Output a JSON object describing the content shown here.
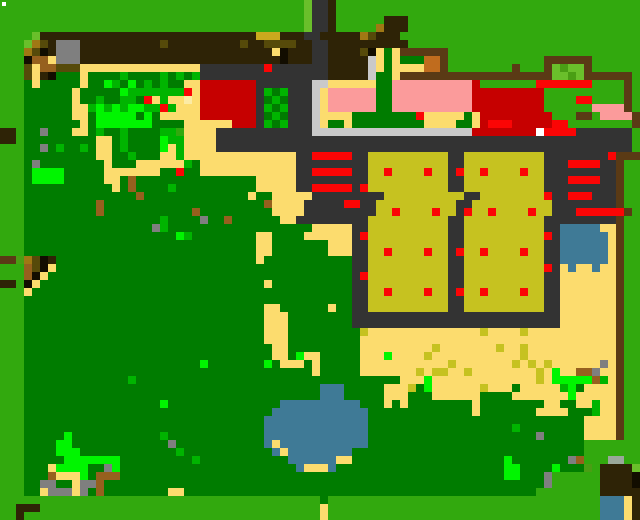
{
  "meta": {
    "type": "pixel-art-game-map",
    "description": "top-down farm/village overview map",
    "grid_cols": 80,
    "grid_rows": 65,
    "cell_size_px": 8,
    "width_px": 640,
    "height_px": 520
  },
  "palette": {
    "a": "#32a90e",
    "b": "#6abf2b",
    "h": "#4a9e14",
    "c": "#007c00",
    "d": "#00b400",
    "e": "#00f500",
    "T": "#fcdc6e",
    "U": "#fceba4",
    "Y": "#c6c220",
    "M": "#c9a91e",
    "m": "#a07814",
    "o": "#564a0a",
    "n": "#96601e",
    "N": "#c06c1e",
    "B": "#2e2306",
    "w": "#5a3a15",
    "k": "#120d00",
    "G": "#7f7f7f",
    "L": "#c9c9c9",
    "S": "#333333",
    "v": "#9aa89a",
    "R": "#c60000",
    "r": "#fb0505",
    "P": "#fb9b9b",
    "Q": "#3f7a96",
    "W": "#ffffff"
  },
  "legend": {
    "a": "grass-bright-green",
    "b": "grass-light-green",
    "h": "grass-olive-green",
    "c": "forest-dark-green",
    "d": "foliage-medium-green",
    "e": "foliage-neon-green",
    "T": "sand-path-tan",
    "U": "sand-pale-cream",
    "Y": "crop-field-olive-yellow",
    "M": "hay-mustard-yellow",
    "m": "dirt-mustard-brown",
    "o": "dirt-dark-olive",
    "n": "dirt-orange-brown",
    "N": "crate-carrot-orange",
    "B": "soil-dark-brown",
    "w": "fence-saddle-brown",
    "k": "shadow-black",
    "G": "rock-gray",
    "L": "path-light-gray",
    "S": "building-wall-slate",
    "v": "lichen-gray-green",
    "R": "roof-dark-red",
    "r": "marker-bright-red",
    "P": "roof-pink",
    "Q": "water-teal",
    "W": "highlight-white"
  },
  "overlays": [
    {
      "name": "cursor-dot",
      "x": 2,
      "y": 2,
      "w": 4,
      "h": 4,
      "color": "#ffffff"
    }
  ],
  "rows": [
    "aaaaaaaaaaaaaaaaaaaaaaaaaaaaaaaaaaaaaabSSBaaaaaaaaaaaaaaaaaaaaaaaaaaaaaaaaaaaaaa",
    "aaaaaaaaaaaaaaaaaaaaaaaaaaaaaaaaaaaaaabSSBaaaaaaaaaaaaaaaaaaaaaaaaaaaaaaaaaaaaaa",
    "aaaaaaaaaaaaaaaaaaaaaaaaaaaaaaaaaaaaaabSSBaaaaaaBBBaaaaaaaaaaaaaaaaaaaaaaaaaaaaa",
    "aaaaaaaaaaaaaaaaaaaaaaaaaaaaaaaaaaaaaabSSBaaaaamBBBaaaaaaaaaaaaaaaaaaaaaaaaaaaaa",
    "aaaabBBBBBBBBBBBBBBBBBBBBBBBBBBBMMMBBBSSBBBBBmoBBBaaaaaaaaaaaaaaaaaaaaaaaaaaaaaa",
    "aaabmoBGGGBBBBBBBBBBoBBBBBBBBBoBBooooBBSSBBBBBBBBBBaaaaaaaaaaaaaaaaaaaaaaaaaaaaa",
    "aaamokBGGGBBBBBBBBBBBBBBBBBBBBBBBBTkBBBSSBBBBokTcTwwwwwwaaaaaaaaaaaaaaaaaaaaaaaa",
    "aaaknnTGGGBBBBBBBBBBBBBBBBBBBBBBBBBkBBBSSBBBBBLTcTcccNNwaaaaaaaaaaaawwwwwwaaaaaa",
    "aaaoTnnoooTTTTTTTTTTTTTTTSSSSSSSSrSSSSSSSBBBBBLTcTTTTNNwaaaaaaaawaaawbhbbwaaaaaa",
    "aaaoTBkcccTccccdccccdcdcdSSSSSSSSSSSSSSSSBBBBBLccTwwwwwwwwwwwwwwwwwwwbbhbwwwwwwa",
    "aaacTcccccTccedcecdcdccTTRRRRRRRSSSSSSSLLTTTTTTccPPPPPPPPPPRaaaaaaarrrrrrraaaawa",
    "aaaccccccTcccccedddddddrTRRRRRRRSdcdSSSLTPPPPPPccPPPPPPPPPPRRRRRRRRRaaaaaaaaaawa",
    "aaaccccccTccdccddcrTdTTUTRRRRRRRScdcSSSLTPPPPPPccPPPPPPPPPPRRRRRRRRRaaaarraaaawa",
    "aaaccccccTTdededeeddrdTTTRRRRRRRSdcdSSSLTPPPPPPccPPPPPPPPPPRRRRRRRRRaaaaaaPPPPwa",
    "aaaccccccTTceeeeecececTTTRRRRRRRScdcSSSLTTTTcccccccrTTTTTcTRRRRRRRRRaawwaPPPPww",
    "aaacccccccTceeeeeeeccccTTTTTTRRRSdcdSSSLTccTccccccccTTTTccTRrrrRRRRRrraaaaaaaawa",
    "BBaccGcccTTcdccdccccddaTTTTSSSSSSSSSSSSLLLLLLLLLLLLLLLLLLLRRRRRRRRRWrrrrSSSSSSS",
    "BBacccccccccTTcdcccceddTTTTSSSSSSSSSSSSSSSSSSSSSSSSSSSSSSSSSSSSSSSSSSSSSSSSSSSS",
    "aaaccGcdccdcTTcdcccceTdTTTTSSSSSSSSSSSSSSSSSSSSSSSSSSSSSSSSSSSSSSSSSSSSSSSSSSSS",
    "aaacccccccccTTccdcccTTdTTTTTTTTTTTTTTSSrrrrrSSYYYYYYYYYYSSYYYYYYYYYYSSSSSSSSrwww",
    "aaacGccccccccTcccTTTTTTdcTTTTTTTTTTTTSSSSSSSSSYYYYYYYYYYSSYYYYYYYYYYSSSrrrrSSwaa",
    "aaaceeeecccccTTTTTTTccrccTTTTTTTTTTTTSSrrrrrSSYYrYYYYrYYSrYYrYYYYrYYSSSSSSSSSwaa",
    "aaaceeeecccccTTcncccccccccccccccTTTTTSSSSSSSSSYYYYYYYYYYSSYYYYYYYYYYSSSrrrrSSwaa",
    "aaacccccccccccTcnccccdccccccccccccTTTTTSSrrrrrSrYYYYYYYYYYSSYYYYYYYYYYSSSSSSSwaa",
    "aaacccccccccccccccnccccccccccccTccTTTTTSSSSSSSSSYYYYYYYYYYSSYYYYYYYYrSSrrrSSSwaa",
    "aaacccccccccncccccccccccccccccccccnTTTTSSSSSrrSSYYYYYYYYYYSSYYYYYYYYYYSSSSSSSwaa",
    "aaacccccccccncccccccccccncccccccccTTTTSSSSSSSSSYYrYYYYrYYSrYYrYYYYrYYSSSrrrrrrwaa",
    "aaacccccccccccccccccdccccGccnccccccCTTSSS"
  ]
}
